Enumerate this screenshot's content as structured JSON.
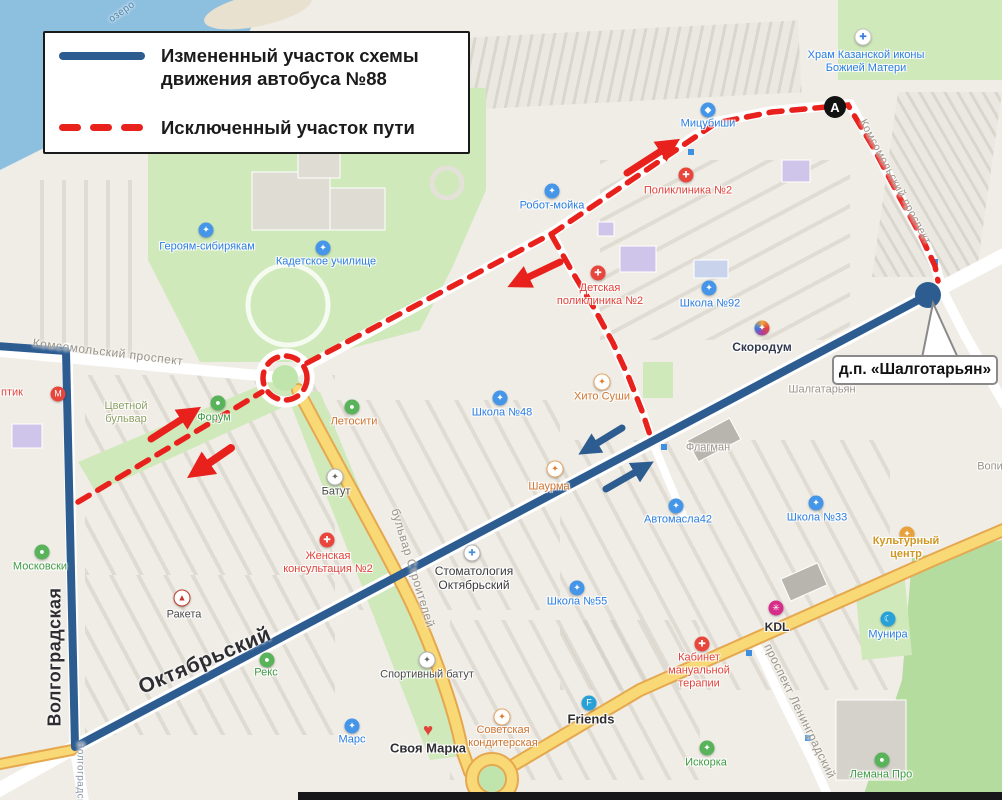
{
  "legend": {
    "items": [
      {
        "style": "solid-blue",
        "label": "Измененный участок схемы движения автобуса №88"
      },
      {
        "style": "dashed-red",
        "label": "Исключенный участок пути"
      }
    ]
  },
  "callout": {
    "text": "д.п. «Шалготарьян»"
  },
  "marker_a": {
    "label": "А"
  },
  "colors": {
    "route_changed": "#2d5c91",
    "route_excluded": "#e8211c",
    "water": "#8dbfdf",
    "park": "#cfe9bb",
    "forest": "#b4dc9e",
    "road_major": "#f9d876",
    "poi_blue": "#2a7de1",
    "poi_red": "#e2423a",
    "poi_orange": "#cf7430",
    "poi_green": "#3f9b43",
    "poi_grey": "#9a948a",
    "poi_dark": "#333a4d"
  },
  "pois": [
    {
      "id": "hram-kazanskoy-ikony",
      "t": "Храм Казанской иконы\nБожией Матери",
      "x": 866,
      "y": 62,
      "c": "#2a7de1",
      "icon": {
        "x": 863,
        "y": 37,
        "bg": "#ffffff",
        "fg": "#3c7ce0",
        "g": "✚",
        "border": "1px solid #c9c9c9"
      }
    },
    {
      "id": "mitsubishi",
      "t": "Мицубиши",
      "x": 708,
      "y": 124,
      "c": "#2a7de1",
      "icon": {
        "x": 708,
        "y": 110,
        "bg": "#4596e8",
        "fg": "#fff",
        "g": "◆"
      }
    },
    {
      "id": "robot-moyka",
      "t": "Робот-мойка",
      "x": 552,
      "y": 206,
      "c": "#2a7de1",
      "icon": {
        "x": 552,
        "y": 191,
        "bg": "#4596e8",
        "fg": "#fff",
        "g": "✦"
      }
    },
    {
      "id": "poliklinika-2",
      "t": "Поликлиника №2",
      "x": 688,
      "y": 191,
      "c": "#e2423a",
      "icon": {
        "x": 686,
        "y": 175,
        "bg": "#e8463c",
        "fg": "#fff",
        "g": "✚"
      }
    },
    {
      "id": "geroyam-sibiryakam",
      "t": "Героям-сибирякам",
      "x": 207,
      "y": 247,
      "c": "#2a7de1",
      "icon": {
        "x": 206,
        "y": 230,
        "bg": "#4596e8",
        "fg": "#fff",
        "g": "✦"
      }
    },
    {
      "id": "kadetskoe-uchilishche",
      "t": "Кадетское училище",
      "x": 326,
      "y": 262,
      "c": "#2a7de1",
      "icon": {
        "x": 323,
        "y": 248,
        "bg": "#4596e8",
        "fg": "#fff",
        "g": "✦"
      }
    },
    {
      "id": "detskaya-poliklinika-2",
      "t": "Детская\nполиклиника №2",
      "x": 600,
      "y": 295,
      "c": "#e2423a",
      "icon": {
        "x": 598,
        "y": 273,
        "bg": "#e8463c",
        "fg": "#fff",
        "g": "✚"
      }
    },
    {
      "id": "shkola-92",
      "t": "Школа №92",
      "x": 710,
      "y": 304,
      "c": "#2a7de1",
      "icon": {
        "x": 709,
        "y": 288,
        "bg": "#4596e8",
        "fg": "#fff",
        "g": "✦"
      }
    },
    {
      "id": "skorodum",
      "t": "Скородум",
      "x": 762,
      "y": 347,
      "c": "#333a4d",
      "s": 12,
      "b": 1,
      "icon": {
        "x": 762,
        "y": 328,
        "bg": "conic-gradient(#f0a63c,#e0453c,#b13ca0,#3c7ce0,#f0a63c)",
        "fg": "#fff",
        "g": "✦"
      }
    },
    {
      "id": "hito-sushi",
      "t": "Хито Суши",
      "x": 602,
      "y": 397,
      "c": "#cf7430",
      "icon": {
        "x": 602,
        "y": 382,
        "bg": "#ffffff",
        "fg": "#e07b28",
        "g": "✦",
        "border": "1px solid #e8a96a"
      }
    },
    {
      "id": "shkola-48",
      "t": "Школа №48",
      "x": 502,
      "y": 413,
      "c": "#2a7de1",
      "icon": {
        "x": 500,
        "y": 398,
        "bg": "#4596e8",
        "fg": "#fff",
        "g": "✦"
      }
    },
    {
      "id": "forum",
      "t": "Форум",
      "x": 214,
      "y": 418,
      "c": "#3f9b43",
      "icon": {
        "x": 218,
        "y": 403,
        "bg": "#59b35a",
        "fg": "#fff",
        "g": "●"
      }
    },
    {
      "id": "tsvetnoy-bulvar",
      "t": "Цветной\nбульвар",
      "x": 126,
      "y": 413,
      "c": "#8d9f63"
    },
    {
      "id": "letosity",
      "t": "Летосити",
      "x": 354,
      "y": 422,
      "c": "#cf7430",
      "icon": {
        "x": 352,
        "y": 407,
        "bg": "#59b35a",
        "fg": "#fff",
        "g": "●"
      }
    },
    {
      "id": "shalgataryan",
      "t": "Шалгатарьян",
      "x": 822,
      "y": 390,
      "c": "#9a948a"
    },
    {
      "id": "flagman",
      "t": "Флагман",
      "x": 708,
      "y": 448,
      "c": "#9a948a"
    },
    {
      "id": "batut",
      "t": "Батут",
      "x": 336,
      "y": 492,
      "c": "#4a4a4a",
      "icon": {
        "x": 335,
        "y": 477,
        "bg": "#ffffff",
        "fg": "#666",
        "g": "✦",
        "border": "1px solid #b5b5b5"
      }
    },
    {
      "id": "shaurma",
      "t": "Шаурма",
      "x": 549,
      "y": 487,
      "c": "#cf7430",
      "icon": {
        "x": 555,
        "y": 469,
        "bg": "#ffffff",
        "fg": "#e07b28",
        "g": "✦",
        "border": "1px solid #e8a96a"
      }
    },
    {
      "id": "avtomasla42",
      "t": "Автомасла42",
      "x": 678,
      "y": 520,
      "c": "#2a7de1",
      "icon": {
        "x": 676,
        "y": 506,
        "bg": "#4596e8",
        "fg": "#fff",
        "g": "✦"
      }
    },
    {
      "id": "shkola-33",
      "t": "Школа №33",
      "x": 817,
      "y": 518,
      "c": "#2a7de1",
      "icon": {
        "x": 816,
        "y": 503,
        "bg": "#4596e8",
        "fg": "#fff",
        "g": "✦"
      }
    },
    {
      "id": "kulturny-tsentr",
      "t": "Культурный центр",
      "x": 906,
      "y": 548,
      "c": "#cf9620",
      "b": 1,
      "icon": {
        "x": 907,
        "y": 534,
        "bg": "#e8a03c",
        "fg": "#fff",
        "g": "✦"
      }
    },
    {
      "id": "vopi",
      "t": "Вопи",
      "x": 990,
      "y": 467,
      "c": "#9a948a"
    },
    {
      "id": "zhenskaya-konsultatsiya-2",
      "t": "Женская\nконсультация №2",
      "x": 328,
      "y": 563,
      "c": "#e2423a",
      "icon": {
        "x": 327,
        "y": 540,
        "bg": "#e8463c",
        "fg": "#fff",
        "g": "✚"
      }
    },
    {
      "id": "stomatologiya-oktyabrsky",
      "t": "Стоматология\nОктябрьский",
      "x": 474,
      "y": 578,
      "c": "#3b3b40",
      "s": 12,
      "icon": {
        "x": 472,
        "y": 553,
        "bg": "#ffffff",
        "fg": "#4a90d9",
        "g": "✚",
        "border": "1px solid #b5b5b5"
      }
    },
    {
      "id": "shkola-55",
      "t": "Школа №55",
      "x": 577,
      "y": 602,
      "c": "#2a7de1",
      "icon": {
        "x": 577,
        "y": 588,
        "bg": "#4596e8",
        "fg": "#fff",
        "g": "✦"
      }
    },
    {
      "id": "moskovsky",
      "t": "Московски",
      "x": 40,
      "y": 567,
      "c": "#3f9b43",
      "icon": {
        "x": 42,
        "y": 552,
        "bg": "#59b35a",
        "fg": "#fff",
        "g": "●"
      }
    },
    {
      "id": "raketa",
      "t": "Ракета",
      "x": 184,
      "y": 615,
      "c": "#4a4a4a",
      "icon": {
        "x": 182,
        "y": 598,
        "bg": "#ffffff",
        "fg": "#c0392b",
        "g": "▲",
        "border": "1px solid #c0392b"
      }
    },
    {
      "id": "rex",
      "t": "Рекс",
      "x": 266,
      "y": 673,
      "c": "#3f9b43",
      "icon": {
        "x": 267,
        "y": 660,
        "bg": "#59b35a",
        "fg": "#fff",
        "g": "●"
      }
    },
    {
      "id": "sportivny-batut",
      "t": "Спортивный батут",
      "x": 427,
      "y": 675,
      "c": "#4a4a4a",
      "icon": {
        "x": 427,
        "y": 660,
        "bg": "#ffffff",
        "fg": "#666",
        "g": "✦",
        "border": "1px solid #b5b5b5"
      }
    },
    {
      "id": "mars",
      "t": "Марс",
      "x": 352,
      "y": 740,
      "c": "#2a7de1",
      "icon": {
        "x": 352,
        "y": 726,
        "bg": "#4596e8",
        "fg": "#fff",
        "g": "✦"
      }
    },
    {
      "id": "svoya-marka",
      "t": "Своя Марка",
      "x": 428,
      "y": 748,
      "c": "#2f2f33",
      "s": 13,
      "b": 1,
      "icon": {
        "x": 428,
        "y": 730,
        "bg": "transparent",
        "fg": "#e0453c",
        "g": "♥",
        "fs": 17
      }
    },
    {
      "id": "sovetskaya-konditerskaya",
      "t": "Советская\nкондитерская",
      "x": 503,
      "y": 737,
      "c": "#cf7430",
      "icon": {
        "x": 502,
        "y": 717,
        "bg": "#ffffff",
        "fg": "#e07b28",
        "g": "✦",
        "border": "1px solid #e8a96a"
      }
    },
    {
      "id": "friends",
      "t": "Friends",
      "x": 591,
      "y": 719,
      "c": "#2f2f33",
      "s": 13,
      "b": 1,
      "icon": {
        "x": 589,
        "y": 703,
        "bg": "#28a0d8",
        "fg": "#fff",
        "g": "F"
      }
    },
    {
      "id": "kabinet-manualnoy-terapii",
      "t": "Кабинет\nмануальной\nтерапии",
      "x": 699,
      "y": 671,
      "c": "#e2423a",
      "icon": {
        "x": 702,
        "y": 644,
        "bg": "#e8463c",
        "fg": "#fff",
        "g": "✚"
      }
    },
    {
      "id": "kdl",
      "t": "KDL",
      "x": 777,
      "y": 627,
      "c": "#2f2f33",
      "s": 12,
      "b": 1,
      "icon": {
        "x": 776,
        "y": 608,
        "bg": "#d62d8a",
        "fg": "#fff",
        "g": "✳"
      }
    },
    {
      "id": "munira",
      "t": "Мунира",
      "x": 888,
      "y": 635,
      "c": "#2a7de1",
      "icon": {
        "x": 888,
        "y": 619,
        "bg": "#28a0d8",
        "fg": "#fff",
        "g": "☾"
      }
    },
    {
      "id": "iskorka",
      "t": "Искорка",
      "x": 706,
      "y": 763,
      "c": "#3f9b43",
      "icon": {
        "x": 707,
        "y": 748,
        "bg": "#59b35a",
        "fg": "#fff",
        "g": "✦"
      }
    },
    {
      "id": "lemana-pro",
      "t": "Лемана Про",
      "x": 881,
      "y": 775,
      "c": "#3f9b43",
      "icon": {
        "x": 882,
        "y": 760,
        "bg": "#59b35a",
        "fg": "#fff",
        "g": "●"
      }
    },
    {
      "id": "magnit",
      "t": "",
      "x": 58,
      "y": 394,
      "c": "#e2423a",
      "icon": {
        "x": 58,
        "y": 394,
        "bg": "#e8463c",
        "fg": "#fff",
        "g": "М"
      }
    },
    {
      "id": "optika-partial",
      "t": "птик",
      "x": 12,
      "y": 393,
      "c": "#e2423a"
    }
  ],
  "streets": [
    {
      "id": "komsomolsky-prospekt-left",
      "t": "Комсомольский проспект",
      "x": 108,
      "y": 352,
      "r": 7,
      "s": 12
    },
    {
      "id": "komsomolsky-prospekt-right",
      "t": "Комсомольский проспект",
      "x": 895,
      "y": 182,
      "r": 62,
      "s": 11
    },
    {
      "id": "bulvar-stroiteley",
      "t": "бульвар Строителей",
      "x": 413,
      "y": 568,
      "r": 73,
      "s": 12
    },
    {
      "id": "prospekt-leningradsky",
      "t": "проспект Ленинградский",
      "x": 800,
      "y": 711,
      "r": 64,
      "s": 12
    },
    {
      "id": "oktyabrsky",
      "t": "Октябрьский",
      "x": 205,
      "y": 661,
      "r": -23,
      "s": 21,
      "b": 1,
      "c": "#2e2e32"
    },
    {
      "id": "volgogradskaya",
      "t": "Волгоградская",
      "x": 55,
      "y": 657,
      "r": -90,
      "s": 18,
      "b": 1,
      "c": "#2e2e32"
    },
    {
      "id": "volgogradskaya-small",
      "t": "Волгоградская",
      "x": 80,
      "y": 779,
      "r": 90,
      "s": 10,
      "c": "#8b95a8"
    },
    {
      "id": "ozero",
      "t": "озеро",
      "x": 122,
      "y": 12,
      "r": -35,
      "s": 10,
      "c": "#4f81a8"
    }
  ]
}
